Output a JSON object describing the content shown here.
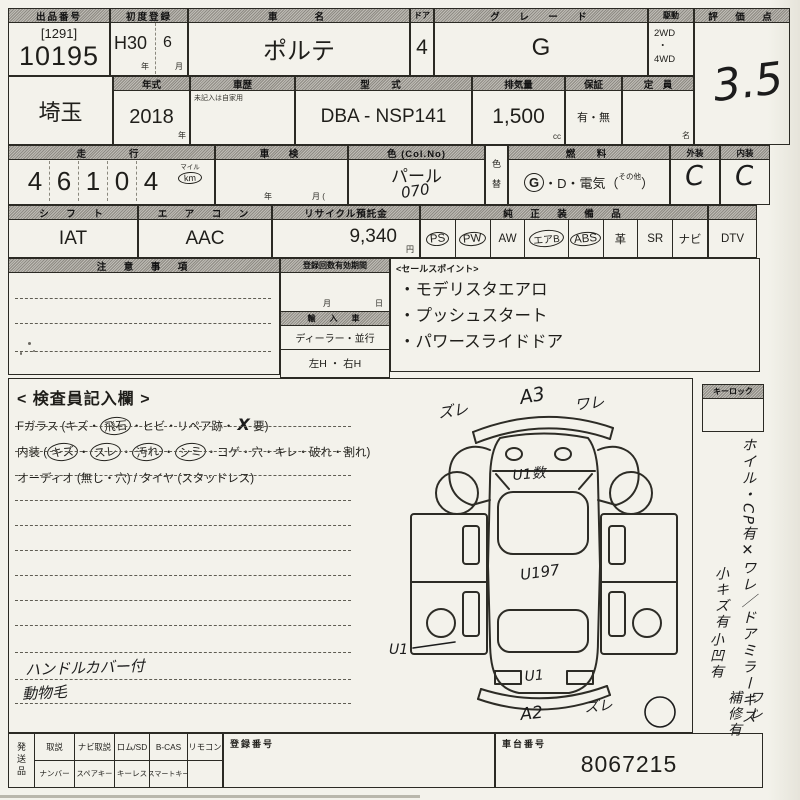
{
  "row1": {
    "lot": {
      "label": "出品番号",
      "bracket": "[1291]",
      "number": "10195"
    },
    "first_reg": {
      "label": "初度登録",
      "era": "H30",
      "month": "6",
      "unit_year": "年",
      "unit_month": "月"
    },
    "car_name": {
      "label": "車　　名",
      "value": "ポルテ"
    },
    "doors": {
      "label": "ドア",
      "value": "4"
    },
    "grade": {
      "label": "グ　レ　ー　ド",
      "value": "G"
    },
    "drive": {
      "label": "駆動",
      "top": "2WD",
      "dot": "・",
      "bottom": "4WD"
    },
    "score": {
      "label": "評　価　点",
      "value": "3.5"
    }
  },
  "row2": {
    "region": {
      "value": "埼玉"
    },
    "year": {
      "label": "年式",
      "value": "2018",
      "unit": "年"
    },
    "history": {
      "label": "車歴",
      "note": "未記入は自家用"
    },
    "model_code": {
      "label": "型　式",
      "value": "DBA - NSP141"
    },
    "displacement": {
      "label": "排気量",
      "value": "1,500",
      "unit": "cc"
    },
    "warranty": {
      "label": "保証",
      "value": "有・無"
    },
    "capacity": {
      "label": "定　員",
      "unit": "名"
    }
  },
  "row3": {
    "odometer": {
      "label": "走　　行",
      "digits": [
        "4",
        "6",
        "1",
        "0",
        "4"
      ],
      "unit_top": "マイル",
      "unit_bottom": "km"
    },
    "shaken": {
      "label": "車　検",
      "unit_year": "年",
      "unit_month": "月 ("
    },
    "color": {
      "label": "色 (Col.No)",
      "value": "パール",
      "code": "070"
    },
    "color_change": {
      "top": "色",
      "bottom": "替"
    },
    "fuel": {
      "label": "燃　料",
      "g": "G",
      "rest": "・D・電気（",
      "other": "その他",
      "close": "）"
    },
    "exterior": {
      "label": "外装",
      "value": "C"
    },
    "interior": {
      "label": "内装",
      "value": "C"
    }
  },
  "row4": {
    "shift": {
      "label": "シ　フ　ト",
      "value": "IAT"
    },
    "aircon": {
      "label": "エ　ア　コ　ン",
      "value": "AAC"
    },
    "recycle": {
      "label": "リサイクル預託金",
      "value": "9,340",
      "unit": "円"
    },
    "equipment": {
      "label": "純　正　装　備　品",
      "items": [
        {
          "label": "PS",
          "circled": true
        },
        {
          "label": "PW",
          "circled": true
        },
        {
          "label": "AW",
          "circled": false
        },
        {
          "label": "エアB",
          "circled": true
        },
        {
          "label": "ABS",
          "circled": true
        },
        {
          "label": "革",
          "circled": false
        },
        {
          "label": "SR",
          "circled": false
        },
        {
          "label": "ナビ",
          "circled": false
        }
      ]
    },
    "dtv": {
      "label": "DTV"
    }
  },
  "notes_box": {
    "label": "注　意　事　項"
  },
  "reg_box": {
    "label": "登録回数有効期間",
    "unit_month": "月",
    "unit_day": "日",
    "import_label": "輸　入　車",
    "import_value": "ディーラー・並行",
    "handle": "左H ・ 右H"
  },
  "sales": {
    "title": "<セールスポイント>",
    "items": [
      "・モデリスタエアロ",
      "・プッシュスタート",
      "・パワースライドドア"
    ]
  },
  "inspector": {
    "title": "< 検査員記入欄 >",
    "f_glass_parts": [
      {
        "t": "Fガラス (キズ・"
      },
      {
        "t": "飛石",
        "c": true
      },
      {
        "t": "・ヒビ・リペア跡・ "
      },
      {
        "t": "X",
        "h": true
      },
      {
        "t": " 要)"
      }
    ],
    "interior_parts": [
      {
        "t": "内装 ("
      },
      {
        "t": "キズ",
        "c": true
      },
      {
        "t": "・"
      },
      {
        "t": "スレ",
        "c": true
      },
      {
        "t": "・"
      },
      {
        "t": "汚れ",
        "c": true
      },
      {
        "t": "・"
      },
      {
        "t": "シミ",
        "c": true
      },
      {
        "t": "・コゲ・穴・キレ・破れ・割れ)"
      }
    ],
    "audio_line": "オーディオ (無し・穴) / タイヤ (スタッドレス)",
    "hand_note1": "ハンドルカバー付",
    "hand_note2": "動物毛"
  },
  "diagram": {
    "ann_top_left": "ズレ",
    "ann_top": "A3",
    "ann_top_right": "ワレ",
    "ann_windshield": "U1数",
    "ann_roof": "U197",
    "ann_left": "U1",
    "ann_rear": "U1",
    "ann_bottom": "A2",
    "ann_bottom_right": "ズレ"
  },
  "sidebar": {
    "keylock_label": "キーロック",
    "v1": "ホイル・CP有✕ワレ／ドアミラーキズ",
    "v2": "ワレ",
    "v3": "小キズ有",
    "v4": "小凹有",
    "v5": "補修有"
  },
  "bottom": {
    "ship_label": "発送品",
    "row1": [
      "取説",
      "ナビ取説",
      "ロム/SD",
      "B-CAS",
      "リモコン"
    ],
    "row2": [
      "ナンバー",
      "スペアキー",
      "キーレス",
      "スマートキー",
      ""
    ],
    "reg_number_label": "登録番号",
    "chassis_label": "車台番号",
    "chassis_value": "8067215"
  }
}
